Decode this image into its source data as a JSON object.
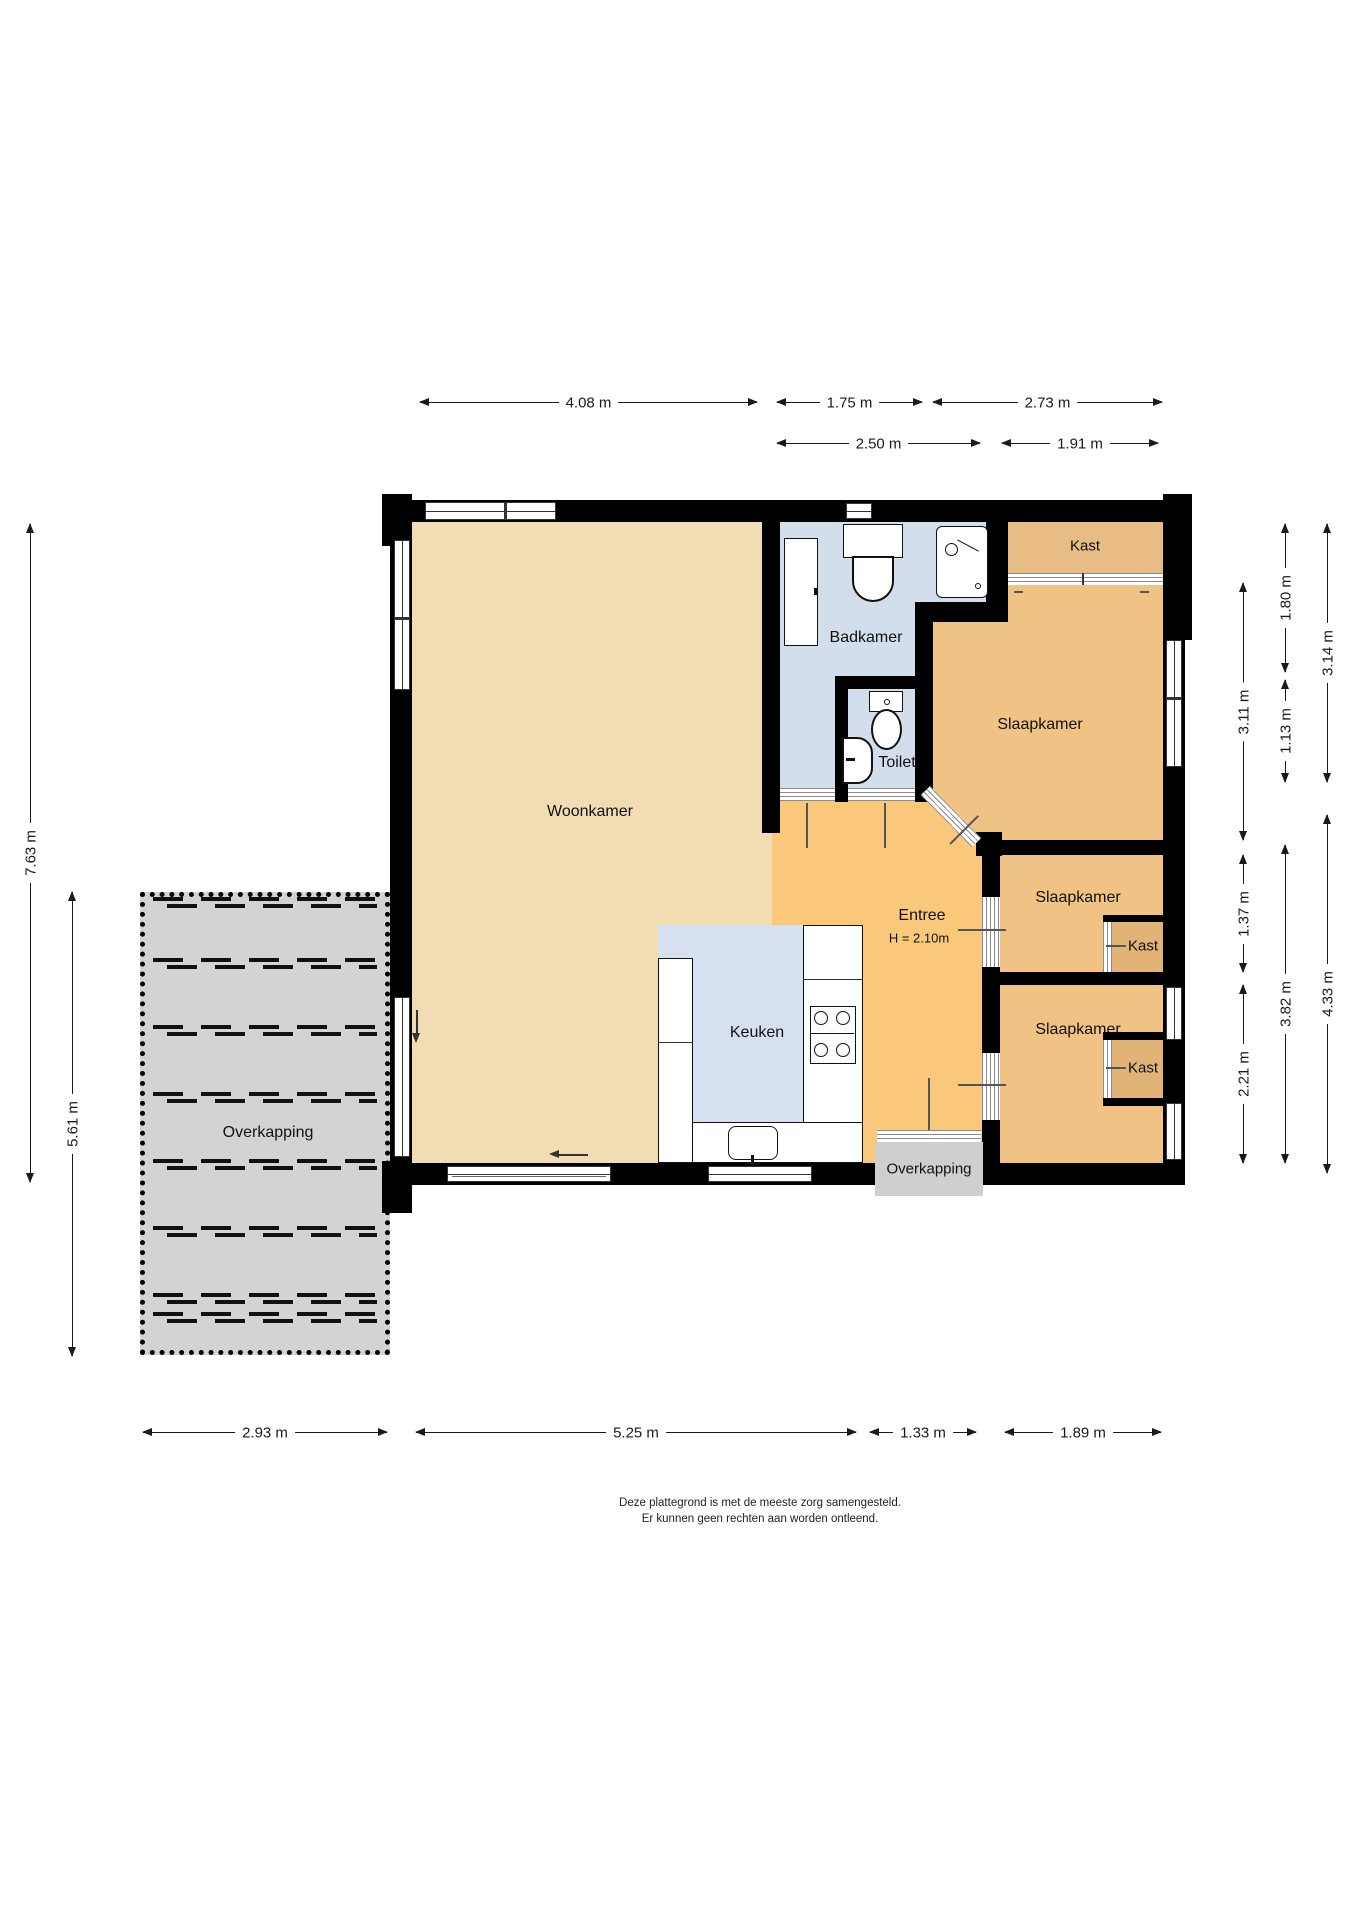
{
  "labels": {
    "woonkamer": "Woonkamer",
    "badkamer": "Badkamer",
    "toilet": "Toilet",
    "slaapkamer": "Slaapkamer",
    "kast": "Kast",
    "entree": "Entree",
    "entree_height": "H = 2.10m",
    "keuken": "Keuken",
    "overkapping": "Overkapping"
  },
  "dimensions": {
    "top_row1": [
      "4.08 m",
      "1.75 m",
      "2.73 m"
    ],
    "top_row2": [
      "2.50 m",
      "1.91 m"
    ],
    "bottom": [
      "2.93 m",
      "5.25 m",
      "1.33 m",
      "1.89 m"
    ],
    "left": [
      "7.63 m",
      "5.61 m"
    ],
    "right_col_inner": [
      "3.11 m",
      "1.37 m",
      "2.21 m"
    ],
    "right_col_middle": [
      "1.80 m",
      "1.13 m",
      "3.82 m"
    ],
    "right_col_outer": [
      "3.14 m",
      "4.33 m"
    ]
  },
  "footer": {
    "line1": "Deze plattegrond is met de meeste zorg samengesteld.",
    "line2": "Er kunnen geen rechten aan worden ontleend."
  },
  "colors": {
    "wall": "#000000",
    "woonkamer": "#f2dcb4",
    "entree": "#f9c87a",
    "slaapkamer": "#f0c283",
    "kast_top": "#e7bd85",
    "kast_small": "#e2b377",
    "bathroom": "#d3deed",
    "keuken": "#d6e0ee",
    "overkapping": "#d3d3d3",
    "overkapping_small": "#cfcfcf",
    "dimension_line": "#1a1a1a"
  }
}
